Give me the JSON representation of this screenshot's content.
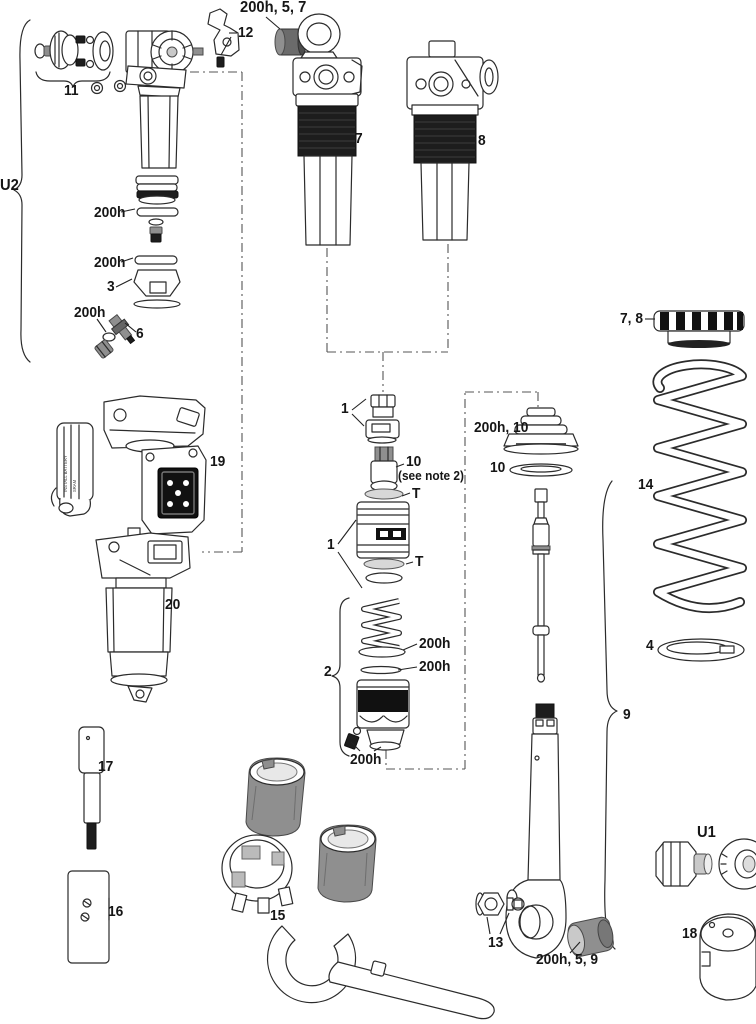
{
  "diagram": {
    "title": "rear shock exploded parts diagram",
    "colors": {
      "line": "#2b2b2b",
      "dark_fill": "#1d1d1d",
      "gray_fill": "#8f8f8f",
      "background": "#ffffff"
    },
    "labels": {
      "u2": "U2",
      "n11": "11",
      "bushing_top": "200h, 5, 7",
      "n12": "12",
      "n7": "7",
      "n8": "8",
      "h200_1": "200h",
      "h200_2": "200h",
      "n3": "3",
      "h200_3": "200h",
      "n6": "6",
      "n19": "19",
      "n20": "20",
      "n1a": "1",
      "n10a": "10",
      "note2": "(see note 2)",
      "t1": "T",
      "n1b": "1",
      "t2": "T",
      "n2": "2",
      "h200_4": "200h",
      "h200_5": "200h",
      "h200_6": "200h",
      "h200_10": "200h, 10",
      "n10b": "10",
      "n78": "7, 8",
      "n14": "14",
      "n4": "4",
      "n9": "9",
      "n13": "13",
      "h200_59": "200h, 5, 9",
      "u1": "U1",
      "n18": "18",
      "n17": "17",
      "n16": "16",
      "n15": "15",
      "battery_line1": "INSTALL BATTERY",
      "battery_line2": "SRAM"
    }
  }
}
